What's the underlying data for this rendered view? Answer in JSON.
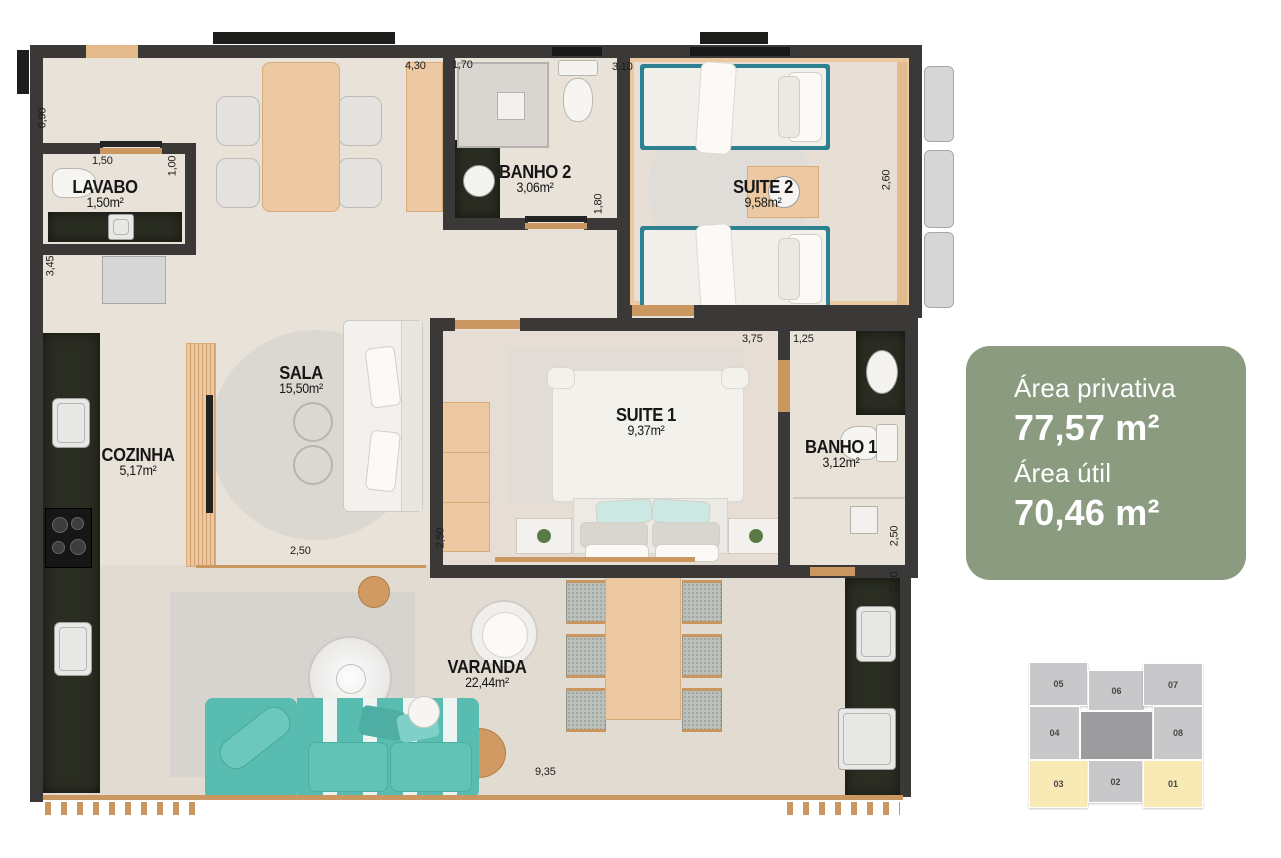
{
  "info_card": {
    "line1_label": "Área privativa",
    "line1_value": "77,57 m²",
    "line2_label": "Área útil",
    "line2_value": "70,46 m²",
    "bg_color": "#8a9b80",
    "text_color": "#ffffff"
  },
  "rooms": [
    {
      "name": "LAVABO",
      "area": "1,50m²"
    },
    {
      "name": "BANHO 2",
      "area": "3,06m²"
    },
    {
      "name": "SUITE 2",
      "area": "9,58m²"
    },
    {
      "name": "SALA",
      "area": "15,50m²"
    },
    {
      "name": "COZINHA",
      "area": "5,17m²"
    },
    {
      "name": "SUITE 1",
      "area": "9,37m²"
    },
    {
      "name": "BANHO 1",
      "area": "3,12m²"
    },
    {
      "name": "VARANDA",
      "area": "22,44m²"
    }
  ],
  "dims": {
    "top_a": "4,30",
    "top_b": "1,70",
    "top_c": "3,10",
    "left_a": "0,90",
    "lavabo_w": "1,50",
    "lavabo_h": "1,00",
    "left_b": "3,45",
    "banho2_h": "1,80",
    "suite2_h": "2,60",
    "suite1_w": "3,75",
    "banho1_w": "1,25",
    "sala_w": "2,50",
    "suite1_h": "2,50",
    "banho1_h": "2,50",
    "varanda_h": "2,40",
    "varanda_w": "9,35"
  },
  "unit_locator": {
    "highlight_color": "#f9e9b4",
    "default_color": "#c8c8cb",
    "units": [
      {
        "id": "05",
        "highlighted": false
      },
      {
        "id": "06",
        "highlighted": false
      },
      {
        "id": "07",
        "highlighted": false
      },
      {
        "id": "04",
        "highlighted": false
      },
      {
        "id": "08",
        "highlighted": false
      },
      {
        "id": "03",
        "highlighted": true
      },
      {
        "id": "02",
        "highlighted": false
      },
      {
        "id": "01",
        "highlighted": true
      }
    ]
  }
}
